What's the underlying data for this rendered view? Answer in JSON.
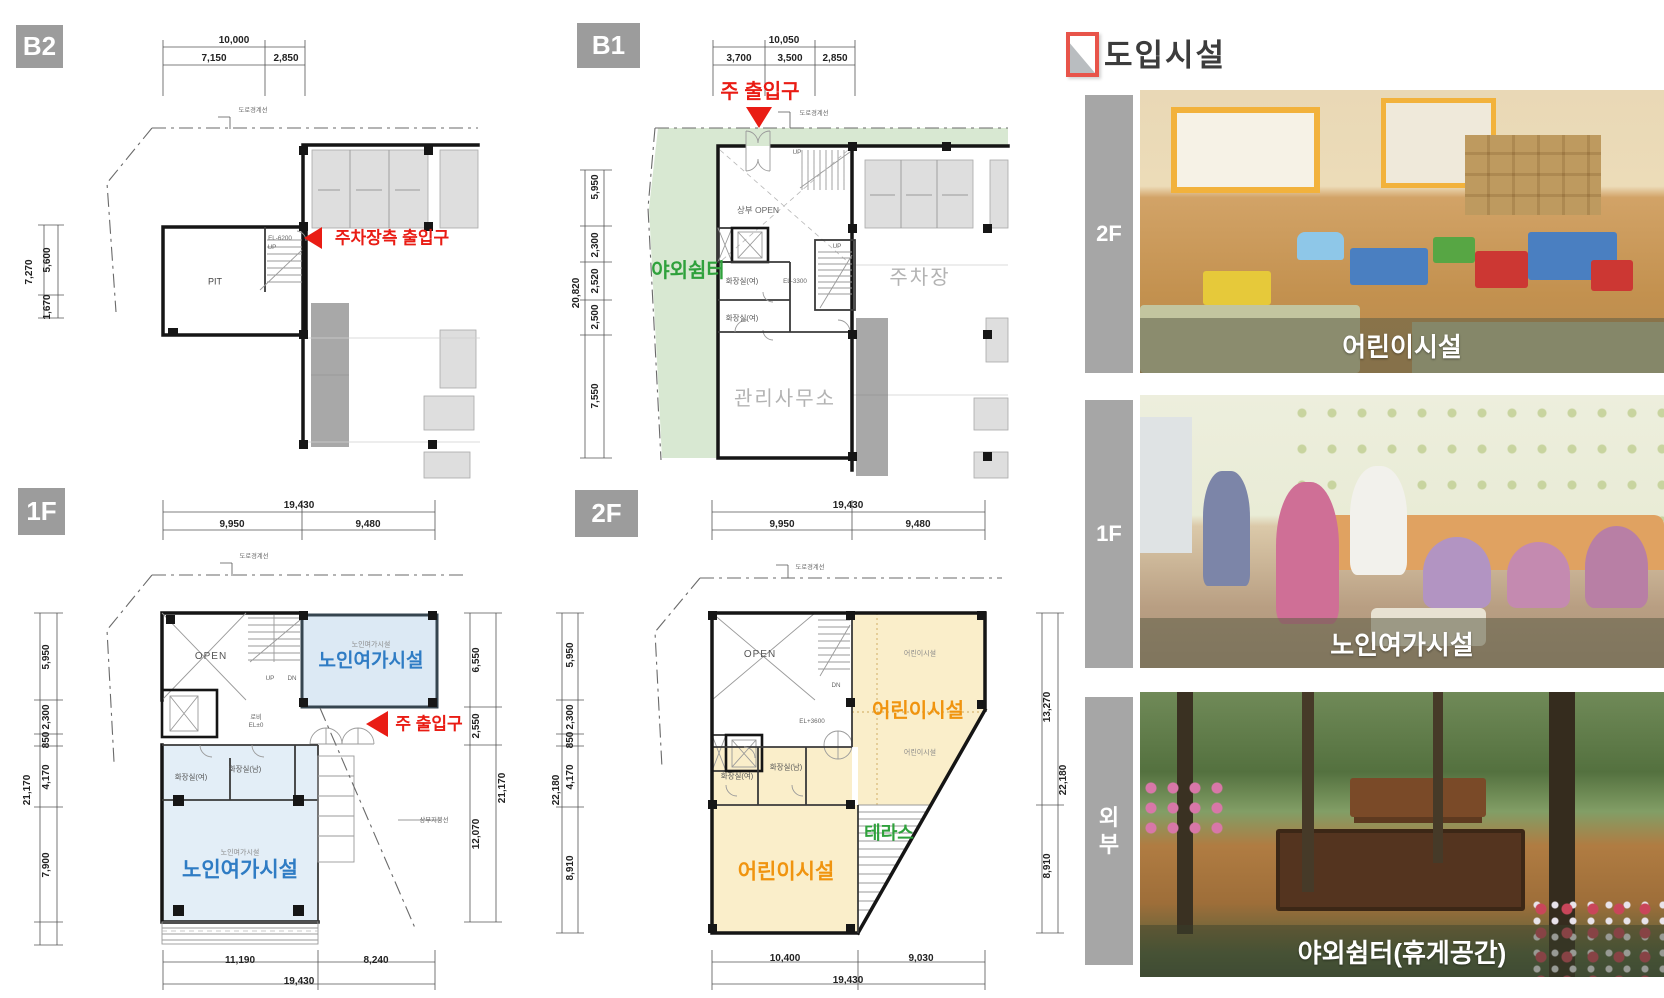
{
  "header": {
    "title": "도입시설"
  },
  "plans": {
    "b2": {
      "badge": "B2",
      "dims": {
        "top_total": "10,000",
        "top_segs": [
          "7,150",
          "2,850"
        ],
        "left_total": "7,270",
        "left_segs": [
          "5,600",
          "1,670"
        ]
      },
      "labels": {
        "road": "도로경계선",
        "pit": "PIT",
        "el": "EL-6200",
        "up": "UP"
      },
      "notes": {
        "parking_entrance": "주차장측 출입구"
      }
    },
    "b1": {
      "badge": "B1",
      "dims": {
        "top_total": "10,050",
        "top_segs": [
          "3,700",
          "3,500",
          "2,850"
        ],
        "left_total": "20,820",
        "left_segs": [
          "5,950",
          "2,300",
          "2,520",
          "2,500",
          "7,550"
        ]
      },
      "labels": {
        "road": "도로경계선",
        "open": "상부 OPEN",
        "toilet_f": "화장실(여)",
        "toilet_f2": "화장실(여)",
        "el": "EL-3300",
        "up": "UP",
        "up2": "UP",
        "parking": "주차장",
        "office": "관리사무소"
      },
      "notes": {
        "main_entrance": "주 출입구",
        "outdoor": "야외쉼터"
      }
    },
    "f1": {
      "badge": "1F",
      "dims": {
        "top_total": "19,430",
        "top_segs": [
          "9,950",
          "9,480"
        ],
        "bottom_total": "19,430",
        "bottom_segs": [
          "11,190",
          "8,240"
        ],
        "left_total": "21,170",
        "left_segs": [
          "5,950",
          "2,300",
          "850",
          "4,170",
          "7,900"
        ],
        "right_total": "21,170",
        "right_segs": [
          "6,550",
          "2,550",
          "12,070"
        ]
      },
      "labels": {
        "road": "도로경계선",
        "open": "OPEN",
        "up": "UP",
        "dn": "DN",
        "lobby": "로비",
        "lobby_el": "EL±0",
        "toilet_f": "화장실(여)",
        "toilet_m": "화장실(남)",
        "senior_small": "노인여가시설",
        "senior_main": "노인여가시설",
        "senior_small2": "노인여가시설",
        "senior_main2": "노인여가시설",
        "roof": "상부지붕선"
      },
      "notes": {
        "main_entrance": "주 출입구"
      }
    },
    "f2": {
      "badge": "2F",
      "dims": {
        "top_total": "19,430",
        "top_segs": [
          "9,950",
          "9,480"
        ],
        "bottom_total": "19,430",
        "bottom_segs": [
          "10,400",
          "9,030"
        ],
        "left_total": "22,180",
        "left_segs": [
          "5,950",
          "2,300",
          "850",
          "4,170",
          "8,910"
        ],
        "right_total": "22,180",
        "right_segs": [
          "13,270",
          "8,910"
        ]
      },
      "labels": {
        "road": "도로경계선",
        "open": "OPEN",
        "dn": "DN",
        "el": "EL+3600",
        "toilet_f": "화장실(여)",
        "toilet_m": "화장실(남)",
        "child_small": "어린이시설",
        "child_main": "어린이시설",
        "child_small2": "어린이시설",
        "child_main2": "어린이시설",
        "terrace": "테라스"
      }
    }
  },
  "facilities": {
    "rows": [
      {
        "floor": "2F",
        "caption": "어린이시설"
      },
      {
        "floor": "1F",
        "caption": "노인여가시설"
      },
      {
        "floor": "외부",
        "caption": "야외쉼터(휴게공간)"
      }
    ]
  },
  "colors": {
    "accent_red": "#e91c14",
    "senior_blue": "#2f7cc4",
    "children_orange": "#f0940f",
    "green_text": "#2fa13c",
    "area_blue": "#dce9f4",
    "area_yellow": "#faeeca",
    "area_green": "#d8e8d2"
  }
}
